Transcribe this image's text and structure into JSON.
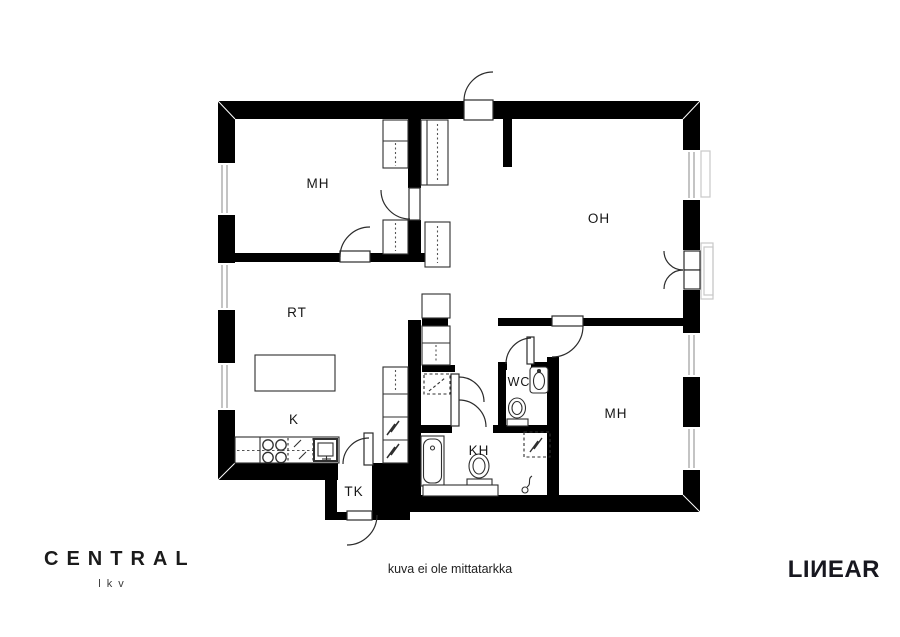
{
  "floor_plan": {
    "rooms": [
      {
        "id": "mh-top",
        "label": "MH"
      },
      {
        "id": "oh",
        "label": "OH"
      },
      {
        "id": "rt",
        "label": "RT"
      },
      {
        "id": "k",
        "label": "K"
      },
      {
        "id": "tk",
        "label": "TK"
      },
      {
        "id": "kh",
        "label": "KH"
      },
      {
        "id": "wc",
        "label": "WC"
      },
      {
        "id": "mh-bottom",
        "label": "MH"
      }
    ],
    "disclaimer": "kuva ei ole mittatarkka"
  },
  "branding": {
    "agency_name": "CENTRAL",
    "agency_subtitle": "lkv",
    "watermark": "LIИEAR"
  },
  "colors": {
    "wall": "#000000",
    "background": "#ffffff",
    "line": "#2b2b2b",
    "window_glass": "#b5b5b5"
  }
}
